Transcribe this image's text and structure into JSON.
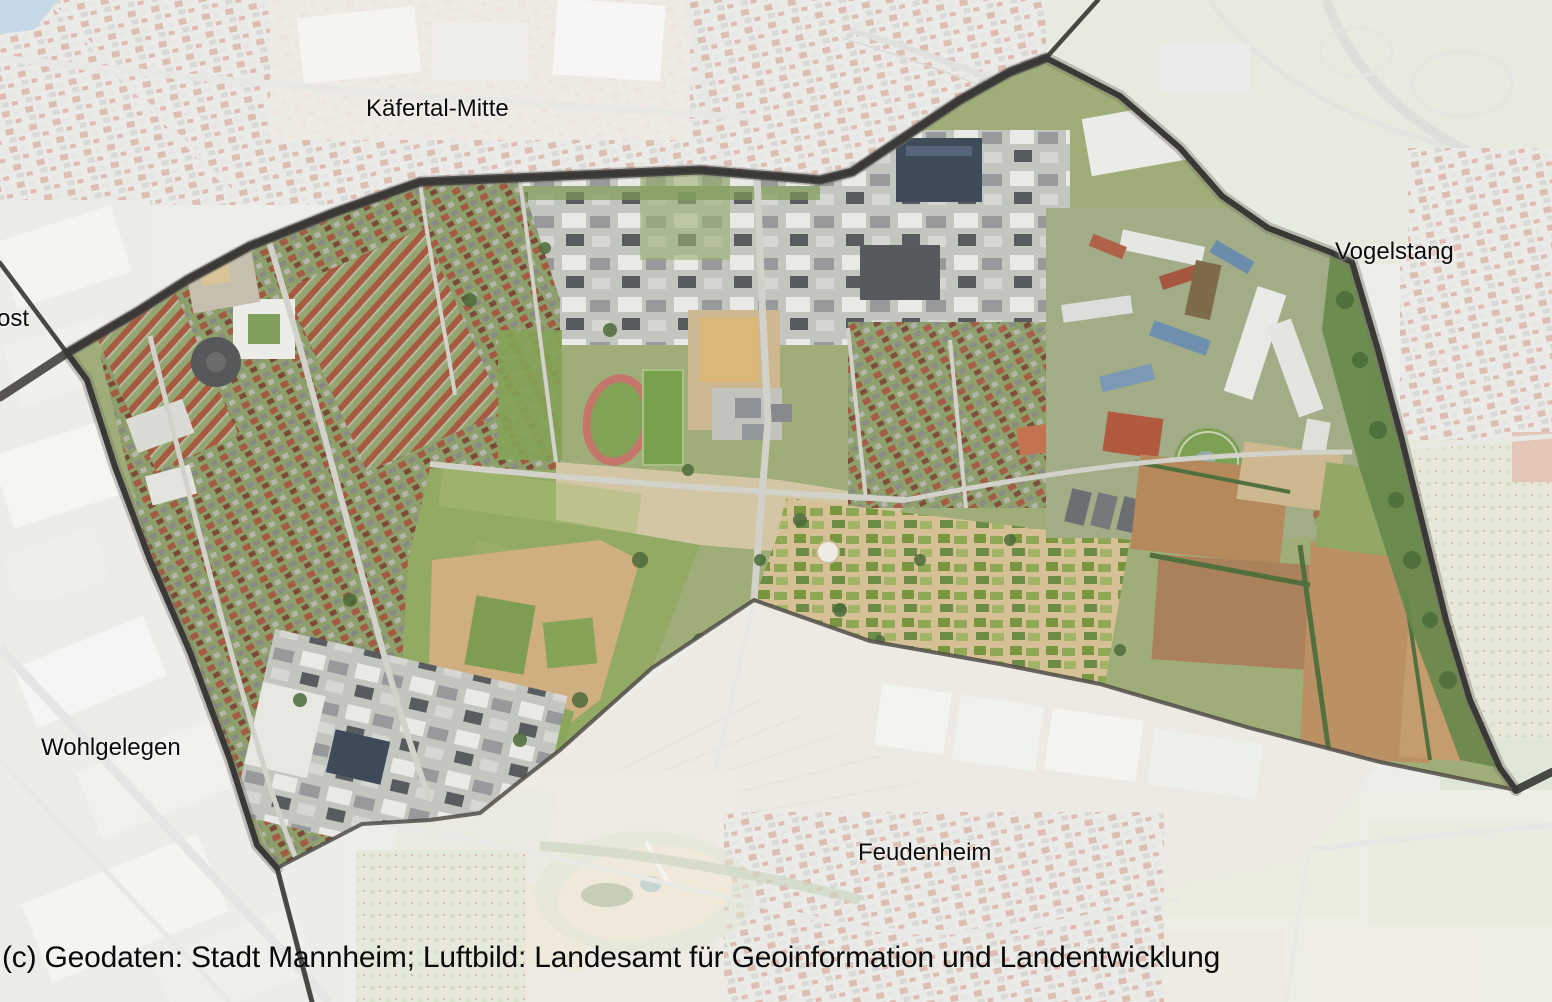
{
  "map": {
    "type": "aerial-imagery-with-district-boundary-overlay",
    "district_labels": [
      {
        "id": "kaefertal-mitte",
        "text": "Käfertal-Mitte"
      },
      {
        "id": "vogelstang",
        "text": "Vogelstang"
      },
      {
        "id": "wohlgelegen",
        "text": "Wohlgelegen"
      },
      {
        "id": "feudenheim",
        "text": "Feudenheim"
      },
      {
        "id": "ost-partial",
        "text": "ost"
      }
    ],
    "copyright": "(c) Geodaten: Stadt Mannheim; Luftbild: Landesamt für Geoinformation und Landentwicklung",
    "theme": {
      "boundary_color": "#3a3936",
      "boundary_soft_color": "#514e48",
      "fade_color": "#ffffff",
      "fade_opacity": "0.56",
      "label_color": "#0d0d0d",
      "water_color": "#7fa9c9"
    }
  }
}
